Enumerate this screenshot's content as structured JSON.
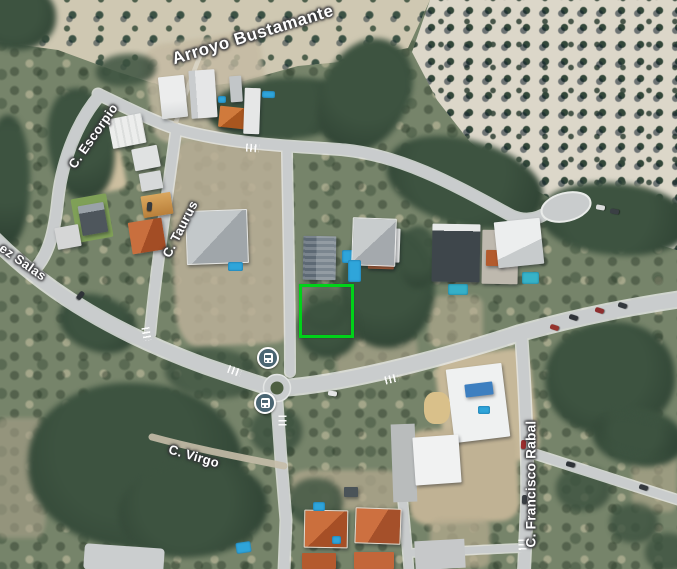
{
  "map_view": {
    "type": "satellite-imagery",
    "labels": {
      "arroyo": {
        "text": "Arroyo Bustamante",
        "kind": "watercourse"
      },
      "escorpio": {
        "text": "C. Escorpio",
        "kind": "street"
      },
      "taurus": {
        "text": "C. Taurus",
        "kind": "street"
      },
      "salas": {
        "text": "ez Salas",
        "kind": "street-partially-cropped"
      },
      "virgo": {
        "text": "C. Virgo",
        "kind": "street"
      },
      "rabal": {
        "text": "C. Francisco Rabal",
        "kind": "street"
      }
    },
    "markers": {
      "bus_stops": [
        {
          "x": 268,
          "y": 358
        },
        {
          "x": 265,
          "y": 403
        }
      ]
    },
    "highlight": {
      "shape": "rectangle",
      "x": 299,
      "y": 284,
      "width": 49,
      "height": 48,
      "stroke_color": "#00d219"
    },
    "palette": {
      "road": "#c9cccd",
      "road_casing": "#e9ebe9",
      "grove_ground_light": "#dcd7c9",
      "grove_ground": "#cfc8b2",
      "scrub": "#76846a",
      "tree_dark": "#35493a",
      "dirt": "#bbb098",
      "pool_blue": "#2fa5da",
      "roof_terracotta": "#b85c30",
      "roof_white": "#ecedec",
      "bus_icon": "#4a6572"
    }
  }
}
